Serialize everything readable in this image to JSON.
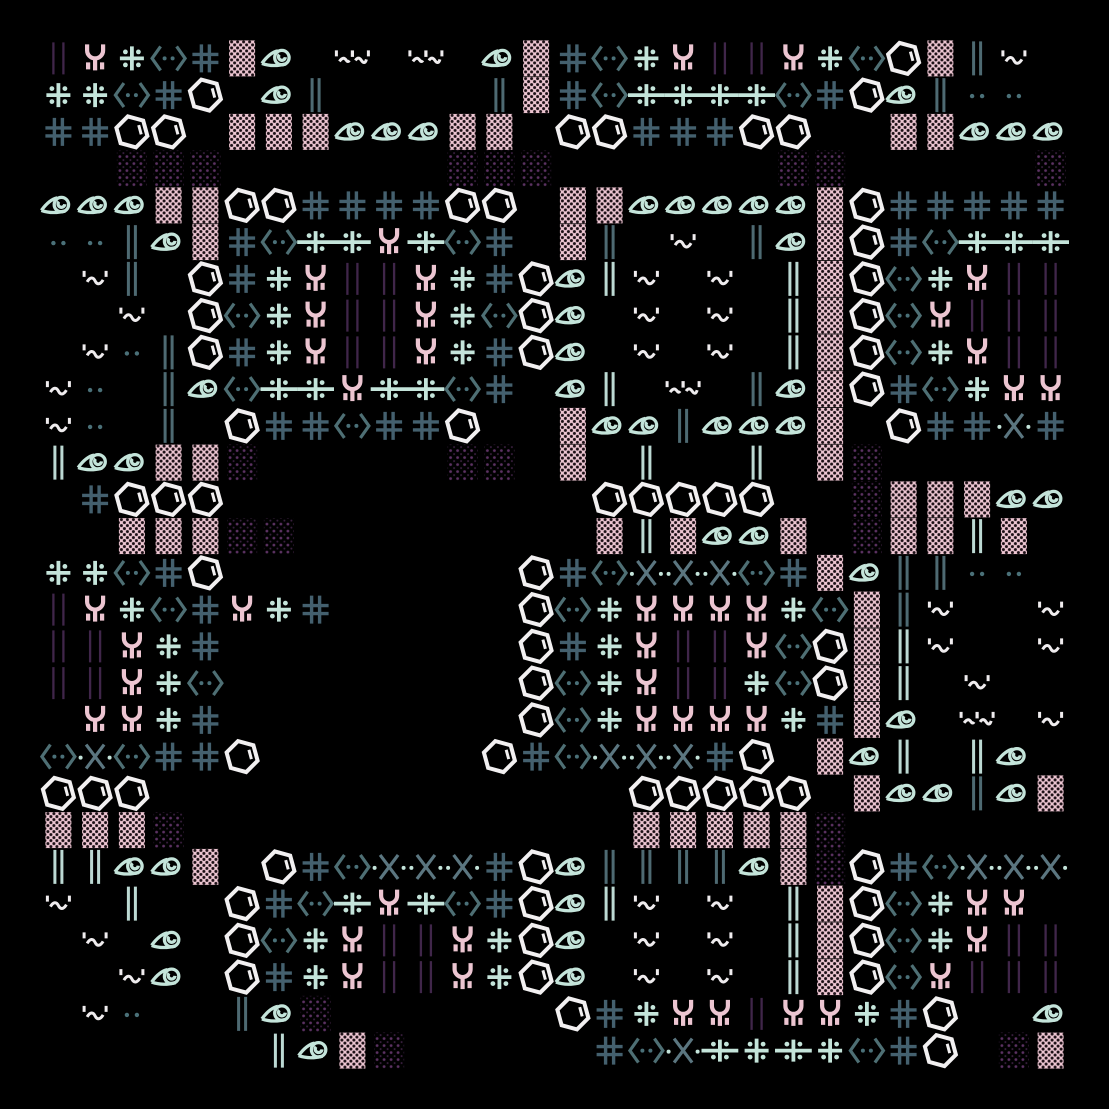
{
  "artwork": {
    "title": "generative-glyph-quilt",
    "canvas": {
      "width": 1109,
      "height": 1109,
      "margin": 40,
      "cell": 36.75,
      "cols": 28,
      "rows": 28
    },
    "background": "#000000",
    "palette": {
      "pink": "#ecc5d1",
      "pink_dot": "#1b0f15",
      "mint": "#c4e4da",
      "mint_bar": "#bcd9d3",
      "white": "#f2f0f1",
      "slate": "#44606e",
      "slate_bar": "#4e6a72",
      "teal_dot": "#4a7078",
      "x_teal": "#5b7680",
      "purple_bar": "#40264a",
      "purple_dot": "#5c3263",
      "purple_dot_dim": "#3a1f40"
    },
    "legend": {
      "h": "benzene-hexagon",
      "#": "slate-hash",
      "+": "mint-dot-cross",
      "C": "mint-chain-cross",
      "Y": "pink-fork",
      "y": "mint-fork",
      "(": "angle-bracket-dots",
      ")": "angle-bracket-dots",
      "X": "teal-x",
      "e": "eye-spiral",
      "b": "pink-dotted-block",
      "d": "purple-dot-patch",
      "|": "slate-double-bar",
      "I": "mint-double-bar",
      "p": "purple-thin-bars",
      "~": "quote-tilde",
      "w": "wide-quote-tilde",
      ".": "teal-dot-pair",
      "_": "empty"
    },
    "grid": [
      "pY+(#be_w_w_eb#(+YppY+(hb|~_",
      "++(#h_e|____|b#(CCCC(#he|.._",
      "##hh_bbbeeebb_hh###hh__bbeee",
      "__ddd______ddd______dd_____d",
      "eeebbhh####hh_bbeeeeebh#####",
      "..|eb#(CCYC(#_b|_~_|ebh#(CCC",
      "_~|_h#+YppY+#heI~_~_Ibh(+Ypp",
      "__~_h(+YppY+(he_~_~_Ibh(Yppp",
      "_~.|h#+YppY+#he_~_~_Ibh(+Ypp",
      "~._|e(CCYCC(#_eI_w_|ebh#(+YY",
      "~._|_h##(##h__bee|eeeb_h##X#",
      "Ieebbd_____dd_b_I__I_bd_____",
      "_#hhh__________hhhhh__dbbbee",
      "__bbbdd________bIbeeb_dbbIb_",
      "++(#h________h#(XXX(#be||.._",
      "pY+(#Y+#_____h(+YYYY+(b|~__~",
      "ppY+#________h#+YppY(hbI~__~",
      "ppY+(________h(+Ypp+(hbI_~__",
      "_YY+#________h(+YYYY+#be_w_~",
      "(X)##h______h#(XXX#h_beI_Ie_",
      "hhh_____________hhhhh_bee|eb",
      "bbbd____________bbbbbd______",
      "IIeeb_h#(XXX#he||||ebdh#(XXX",
      "~_I__h#(CYC(#heI~_~_Ibh(+YY_",
      "_~_e_h(+YppY+he_~_~_Ibh(+Ypp",
      "__~e_h#+YppY+he_~_~_Ibh(Yppp",
      "_~.__|ed______h#+YYpYY+#h__e",
      "______Iebd_____#(XC+C+(#h_db"
    ]
  }
}
